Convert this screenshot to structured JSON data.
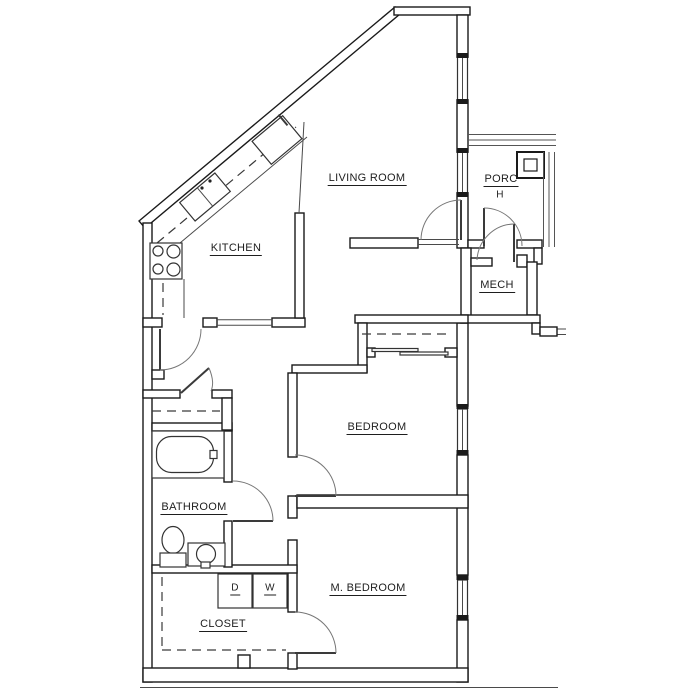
{
  "drawing": {
    "type": "apartment floor plan",
    "rooms": {
      "living_room": "LIVING ROOM",
      "kitchen": "KITCHEN",
      "porch_line1": "PORC",
      "porch_line2": "H",
      "mech": "MECH",
      "bedroom": "BEDROOM",
      "bathroom": "BATHROOM",
      "master_bedroom": "M. BEDROOM",
      "closet": "CLOSET"
    },
    "appliances": {
      "dryer": "D",
      "washer": "W"
    },
    "fixtures": {
      "bathtub": "bathtub",
      "toilet": "toilet",
      "bathroom_sink": "round vanity sink",
      "kitchen_sink": "double-basin sink",
      "stove": "four-burner range",
      "refrigerator": "refrigerator",
      "porch_column": "square column",
      "railings": "porch railings",
      "windows": "wall windows",
      "doors": "hinged door swings",
      "sliding_closet_door": "bypass closet doors"
    },
    "colors": {
      "wall_line": "#1a1a1a",
      "fixture_line": "#333333",
      "door_line": "#777777",
      "dashed_line": "#3a3a3a",
      "text": "#1e1e1e",
      "background": "#ffffff"
    }
  }
}
